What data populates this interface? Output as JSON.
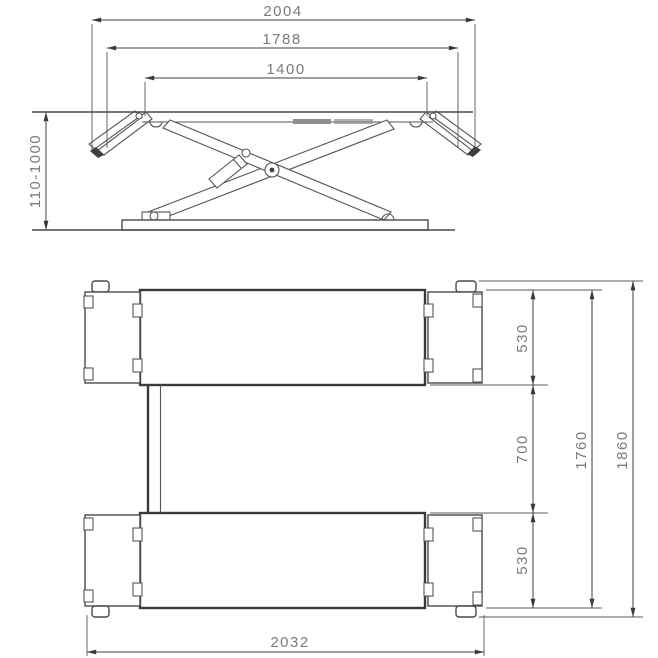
{
  "style": {
    "background": "#ffffff",
    "line_color": "#4a4a4a",
    "dim_line_color": "#3f3f3f",
    "dim_text_color": "#7b7b7b",
    "pad_color": "#8f8f8f"
  },
  "side_view": {
    "dim_overall_width": "2004",
    "dim_rail_outer_span": "1788",
    "dim_rail_inner_span": "1400",
    "dim_height_range": "110-1000"
  },
  "plan_view": {
    "dim_platform_width_top": "530",
    "dim_center_gap": "700",
    "dim_platform_width_bottom": "530",
    "dim_platforms_span": "1760",
    "dim_overall_span": "1860",
    "dim_base_length": "2032"
  }
}
